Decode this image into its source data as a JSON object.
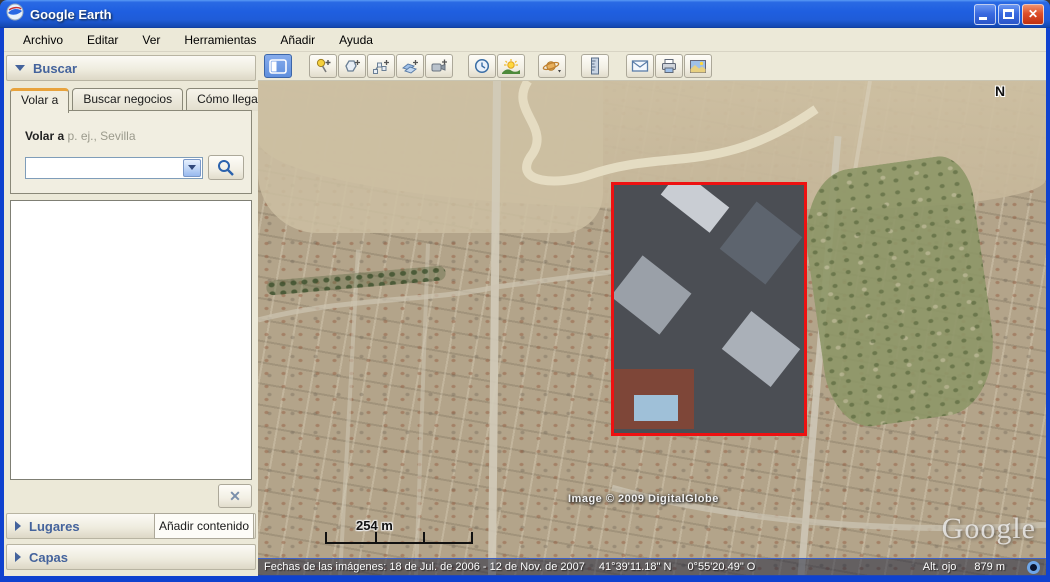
{
  "window": {
    "title": "Google Earth"
  },
  "menu": {
    "items": [
      "Archivo",
      "Editar",
      "Ver",
      "Herramientas",
      "Añadir",
      "Ayuda"
    ]
  },
  "toolbar": {
    "buttons": [
      "toggle-sidebar",
      "add-placemark",
      "add-polygon",
      "add-path",
      "add-image-overlay",
      "record-tour",
      "historical-imagery",
      "sunlight",
      "switch-planet",
      "ruler",
      "email",
      "print",
      "save-image"
    ]
  },
  "search": {
    "header": "Buscar",
    "tabs": [
      "Volar a",
      "Buscar negocios",
      "Cómo llegar"
    ],
    "flyto_label": "Volar a",
    "flyto_hint": "p. ej., Sevilla",
    "input_value": "",
    "clear_glyph": "✕"
  },
  "panels": {
    "lugares": "Lugares",
    "add_content": "Añadir contenido",
    "capas": "Capas"
  },
  "map": {
    "compass": "N",
    "scale_label": "254 m",
    "copyright": "Image © 2009 DigitalGlobe",
    "logo": "Google"
  },
  "status": {
    "dates": "Fechas de las imágenes: 18 de Jul. de 2006 - 12 de Nov. de 2007",
    "latitude": "41°39'11.18\" N",
    "longitude": "0°55'20.49\" O",
    "eye_alt_label": "Alt. ojo",
    "eye_alt_value": "879 m"
  },
  "colors": {
    "selection_red": "#ee1111",
    "titlebar_blue": "#1f5fe0",
    "window_border": "#0f42cf",
    "panel_text": "#44639c"
  }
}
